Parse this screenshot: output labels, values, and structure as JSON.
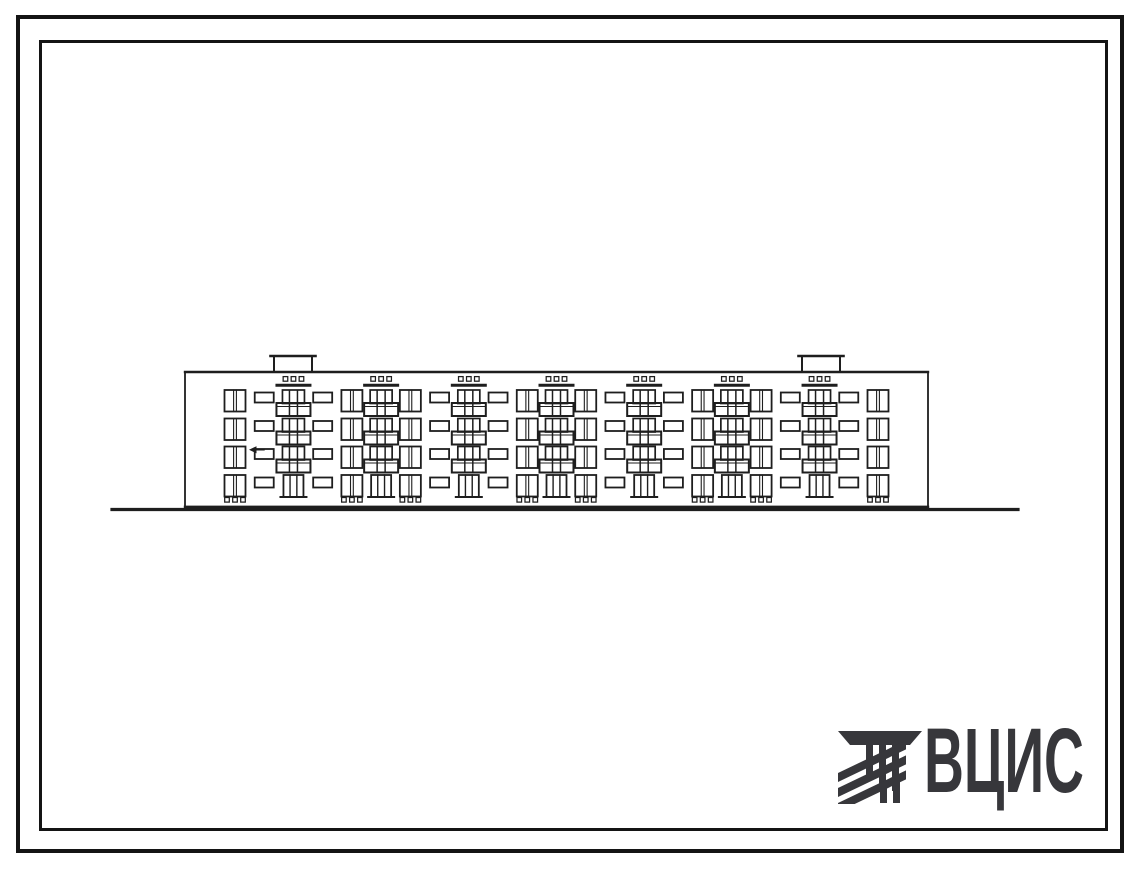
{
  "logo": {
    "text": "ВЦИС",
    "color": "#37373b",
    "icon": "hatched-stripes-emblem"
  },
  "colors": {
    "ink": "#1e1e1e",
    "paper": "#ffffff",
    "frame": "#141414"
  },
  "elevation": {
    "description": "Hand-drawn facade elevation of a 4-storey panel apartment block",
    "floors": 4,
    "building": {
      "x": 185,
      "y": 372,
      "width": 743,
      "bottom": 506.8
    },
    "ground_line": {
      "x1": 112,
      "x2": 1018,
      "y": 509.5
    },
    "row_tops": [
      390,
      418.5,
      446.5,
      475
    ],
    "column_pattern": [
      "W",
      "S",
      "B",
      "S",
      "W",
      "B",
      "W",
      "S",
      "B",
      "S",
      "W",
      "B",
      "W",
      "S",
      "B",
      "S",
      "W",
      "B",
      "W",
      "S",
      "B",
      "S",
      "W"
    ],
    "first_column_center": 235,
    "last_column_center": 878,
    "balcony_column_count": 7,
    "window_column_count": 8,
    "small_window_column_count": 8,
    "chimneys": [
      {
        "cx": 293,
        "width": 38,
        "height": 16
      },
      {
        "cx": 821,
        "width": 38,
        "height": 16
      }
    ],
    "attic_vent_rows": "three small vents above each balcony stack",
    "basement_vent_rows": "three small vents below each window stack",
    "level_mark": {
      "x": 249,
      "y": 449.8
    }
  }
}
